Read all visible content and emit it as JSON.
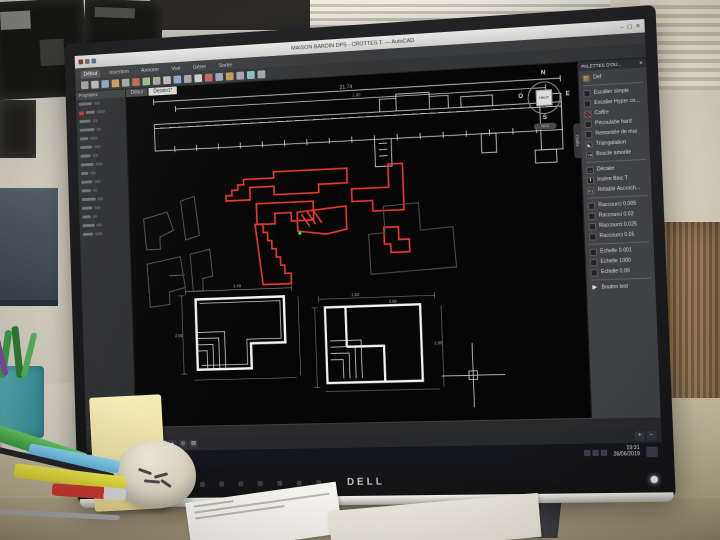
{
  "window": {
    "title": "MAISON BARDIN DPS - CROTTES T. — AutoCAD",
    "controls": {
      "minimize": "–",
      "maximize": "▢",
      "close": "✕"
    }
  },
  "ribbon": {
    "tabs": [
      {
        "label": "Début",
        "active": true
      },
      {
        "label": "Insertion",
        "active": false
      },
      {
        "label": "Annoter",
        "active": false
      },
      {
        "label": "Vue",
        "active": false
      },
      {
        "label": "Gérer",
        "active": false
      },
      {
        "label": "Sortie",
        "active": false
      }
    ]
  },
  "file_tabs": [
    {
      "label": "Début",
      "active": false
    },
    {
      "label": "Dessin1*",
      "active": true
    }
  ],
  "properties_palette": {
    "title": "Propriétés"
  },
  "tool_palette": {
    "header": "PALETTES D'OU...",
    "close": "✕",
    "side_tab": "Outils",
    "groups": [
      {
        "items": [
          {
            "icon": "image-icon",
            "label": "Def"
          }
        ]
      },
      {
        "items": [
          {
            "icon": "block-icon",
            "label": "Escalier simple"
          },
          {
            "icon": "block-icon",
            "label": "Escalier Hyper co..."
          },
          {
            "icon": "hatch-icon",
            "label": "Coffre"
          },
          {
            "icon": "block-icon",
            "label": "Pécoulabe hard"
          },
          {
            "icon": "wall-icon",
            "label": "Remontée de mur"
          },
          {
            "icon": "triangle-icon",
            "label": "Triangulation"
          },
          {
            "icon": "tr-icon",
            "label": "Boucle amortie"
          }
        ]
      },
      {
        "items": [
          {
            "icon": "offset-icon",
            "label": "Décaler"
          },
          {
            "icon": "text-icon",
            "label": "Insère Bloc T"
          },
          {
            "icon": "f1-icon",
            "label": "Rétablir Accroch..."
          }
        ]
      },
      {
        "items": [
          {
            "icon": "macro-icon",
            "label": "Raccourci 0.005"
          },
          {
            "icon": "macro-icon",
            "label": "Raccourci 0.02"
          },
          {
            "icon": "macro-icon",
            "label": "Raccourci 0.025"
          },
          {
            "icon": "macro-icon",
            "label": "Raccourci 0.05"
          }
        ]
      },
      {
        "items": [
          {
            "icon": "scale-icon",
            "label": "Echelle 0.001"
          },
          {
            "icon": "scale-icon",
            "label": "Echelle 1000"
          },
          {
            "icon": "scale-icon",
            "label": "Echelle 0.99"
          }
        ]
      },
      {
        "items": [
          {
            "icon": "arrow-icon",
            "label": "Bouton test"
          }
        ]
      }
    ]
  },
  "viewcube": {
    "north": "N",
    "south": "S",
    "east": "E",
    "west": "O",
    "center": "HAUT",
    "ucs": "SCU"
  },
  "canvas": {
    "dimensions": {
      "elev_total": "21.74",
      "elev_inner": "2.80",
      "plan_left_w": "3.49",
      "plan_left_h": "2.65",
      "plan_right_w": "1.63",
      "plan_right_top": "2.80",
      "plan_right_side": "1.80"
    }
  },
  "command_line": {
    "prompt": "Tapez une commande"
  },
  "status_bar": {
    "model_label": "MODÈLE",
    "icons": [
      {
        "glyph": "#",
        "active": true
      },
      {
        "glyph": "∠",
        "active": false
      },
      {
        "glyph": "⊥",
        "active": true
      },
      {
        "glyph": "◇",
        "active": false
      },
      {
        "glyph": "▦",
        "active": true
      },
      {
        "glyph": "+",
        "active": false
      },
      {
        "glyph": "◎",
        "active": false
      },
      {
        "glyph": "▤",
        "active": false
      }
    ]
  },
  "taskbar": {
    "start_glyph": "⊞",
    "apps": [
      "folder-icon",
      "autocad-icon"
    ],
    "tray_icons": [
      "arrow-up-icon",
      "network-icon",
      "volume-icon"
    ],
    "time": "19:31",
    "date": "26/06/2019"
  },
  "monitor": {
    "brand": "DELL",
    "label": "E726BM"
  }
}
